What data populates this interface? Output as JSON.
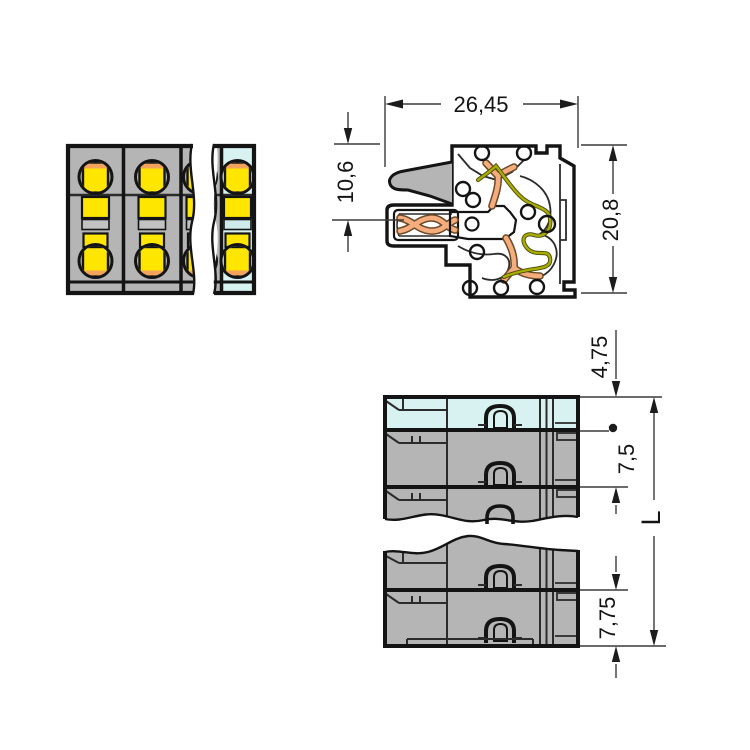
{
  "dimensions": {
    "section_width": "26,45",
    "wire_entry_height": "10,6",
    "section_height": "20,8",
    "end_clearance": "4,75",
    "pole_pitch": "7,5",
    "total_length": "L",
    "end_pole_pitch": "7,75"
  },
  "colors": {
    "housing_gray": "#b5b5b5",
    "end_pole_cyan": "#d8f1f1",
    "contact_yellow": "#ffe600",
    "copper_orange": "#f2a35c",
    "busbar_salmon": "#f6ad7d",
    "spring_olive": "#a9ad00",
    "outline_black": "#141414",
    "background": "#ffffff"
  }
}
